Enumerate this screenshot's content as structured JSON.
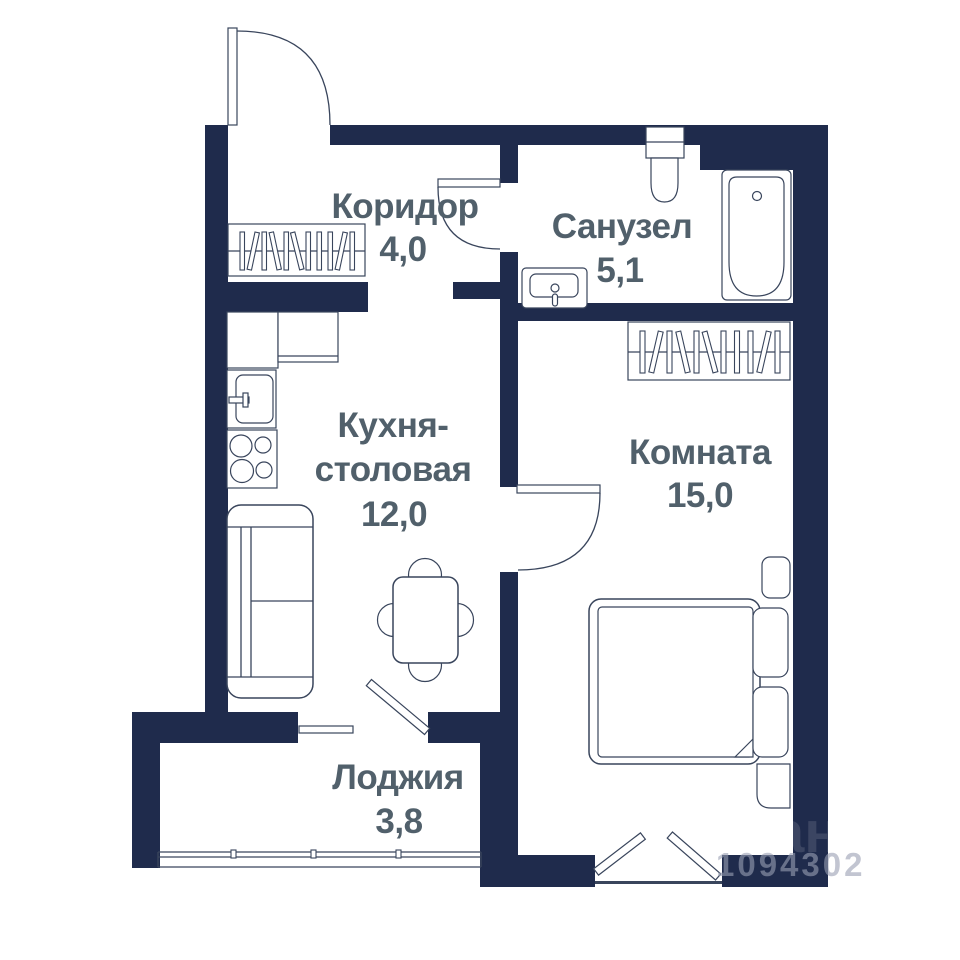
{
  "rooms": [
    {
      "id": "corridor",
      "name": "Коридор",
      "area": "4,0"
    },
    {
      "id": "bathroom",
      "name": "Санузел",
      "area": "5,1"
    },
    {
      "id": "kitchen-dining",
      "name_lines": [
        "Кухня-",
        "столовая"
      ],
      "area": "12,0"
    },
    {
      "id": "living-room",
      "name": "Комната",
      "area": "15,0"
    },
    {
      "id": "loggia",
      "name": "Лоджия",
      "area": "3,8"
    }
  ],
  "watermark": {
    "letters": "ан",
    "digits": "1094302"
  },
  "colors": {
    "wall": "#1f2b4c",
    "line": "#39455c",
    "label": "#51606b",
    "watermark_digits": "#9aa0b4",
    "background": "#ffffff"
  }
}
